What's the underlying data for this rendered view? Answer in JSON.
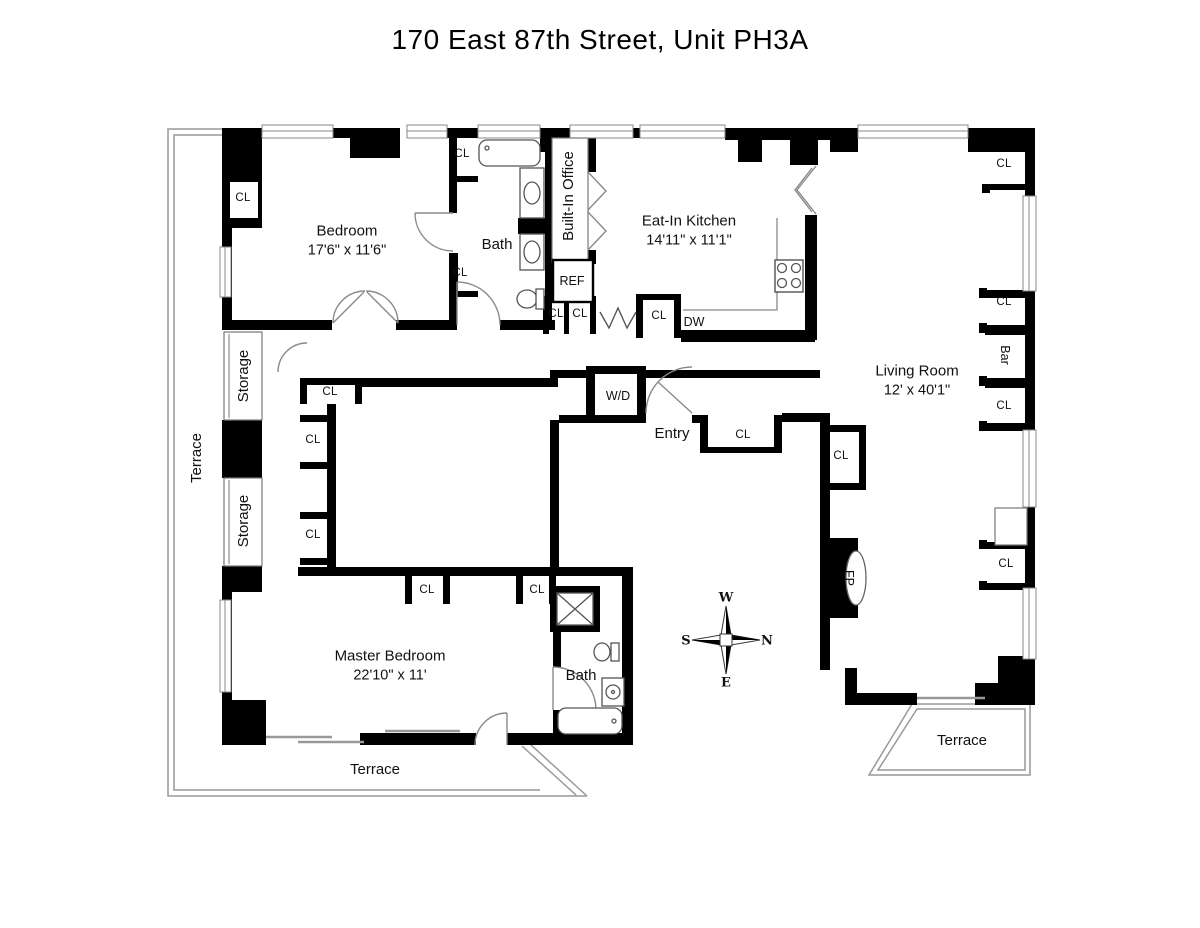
{
  "title": "170 East 87th Street, Unit PH3A",
  "closet_label": "CL",
  "colors": {
    "wall": "#000000",
    "background": "#ffffff",
    "thin_line": "#888888",
    "text": "#111111"
  },
  "rooms": [
    {
      "id": "bedroom",
      "name": "Bedroom",
      "dims": "17'6\" x 11'6\"",
      "x": 347,
      "y": 241,
      "rot": 0
    },
    {
      "id": "eat-in-kitchen",
      "name": "Eat-In Kitchen",
      "dims": "14'11\" x 11'1\"",
      "x": 689,
      "y": 231,
      "rot": 0
    },
    {
      "id": "living-room",
      "name": "Living Room",
      "dims": "12' x 40'1\"",
      "x": 917,
      "y": 381,
      "rot": 0
    },
    {
      "id": "master-bedroom",
      "name": "Master Bedroom",
      "dims": "22'10\" x 11'",
      "x": 390,
      "y": 666,
      "rot": 0
    },
    {
      "id": "bath",
      "name": "Bath",
      "dims": "",
      "x": 497,
      "y": 245,
      "rot": 0
    },
    {
      "id": "master-bath",
      "name": "Bath",
      "dims": "",
      "x": 581,
      "y": 676,
      "rot": 0
    },
    {
      "id": "built-in-office",
      "name": "Built-In Office",
      "dims": "",
      "x": 569,
      "y": 196,
      "rot": -90
    },
    {
      "id": "entry",
      "name": "Entry",
      "dims": "",
      "x": 672,
      "y": 434,
      "rot": 0
    },
    {
      "id": "storage-1",
      "name": "Storage",
      "dims": "",
      "x": 244,
      "y": 376,
      "rot": -90
    },
    {
      "id": "storage-2",
      "name": "Storage",
      "dims": "",
      "x": 244,
      "y": 521,
      "rot": -90
    },
    {
      "id": "terrace-left",
      "name": "Terrace",
      "dims": "",
      "x": 197,
      "y": 458,
      "rot": -90
    },
    {
      "id": "terrace-bottom",
      "name": "Terrace",
      "dims": "",
      "x": 375,
      "y": 770,
      "rot": 0
    },
    {
      "id": "terrace-right",
      "name": "Terrace",
      "dims": "",
      "x": 962,
      "y": 741,
      "rot": 0
    }
  ],
  "features": [
    {
      "id": "washer-dryer",
      "text": "W/D",
      "x": 618,
      "y": 396,
      "rot": 0
    },
    {
      "id": "refrigerator",
      "text": "REF",
      "x": 572,
      "y": 281,
      "rot": 0
    },
    {
      "id": "dishwasher",
      "text": "DW",
      "x": 694,
      "y": 322,
      "rot": 0
    },
    {
      "id": "bar",
      "text": "Bar",
      "x": 1005,
      "y": 355,
      "rot": 90
    },
    {
      "id": "fireplace",
      "text": "FP",
      "x": 849,
      "y": 578,
      "rot": 90
    }
  ],
  "closets": [
    {
      "x": 243,
      "y": 198
    },
    {
      "x": 462,
      "y": 154
    },
    {
      "x": 460,
      "y": 273
    },
    {
      "x": 556,
      "y": 314
    },
    {
      "x": 580,
      "y": 314
    },
    {
      "x": 659,
      "y": 316
    },
    {
      "x": 1004,
      "y": 164
    },
    {
      "x": 1004,
      "y": 302
    },
    {
      "x": 1004,
      "y": 406
    },
    {
      "x": 330,
      "y": 392
    },
    {
      "x": 313,
      "y": 440
    },
    {
      "x": 313,
      "y": 535
    },
    {
      "x": 743,
      "y": 435
    },
    {
      "x": 841,
      "y": 456
    },
    {
      "x": 1006,
      "y": 564
    },
    {
      "x": 427,
      "y": 590
    },
    {
      "x": 537,
      "y": 590
    }
  ],
  "compass": {
    "points": [
      {
        "dir": "W",
        "x": 726,
        "y": 598
      },
      {
        "dir": "N",
        "x": 767,
        "y": 641
      },
      {
        "dir": "E",
        "x": 726,
        "y": 683
      },
      {
        "dir": "S",
        "x": 686,
        "y": 641
      }
    ]
  }
}
